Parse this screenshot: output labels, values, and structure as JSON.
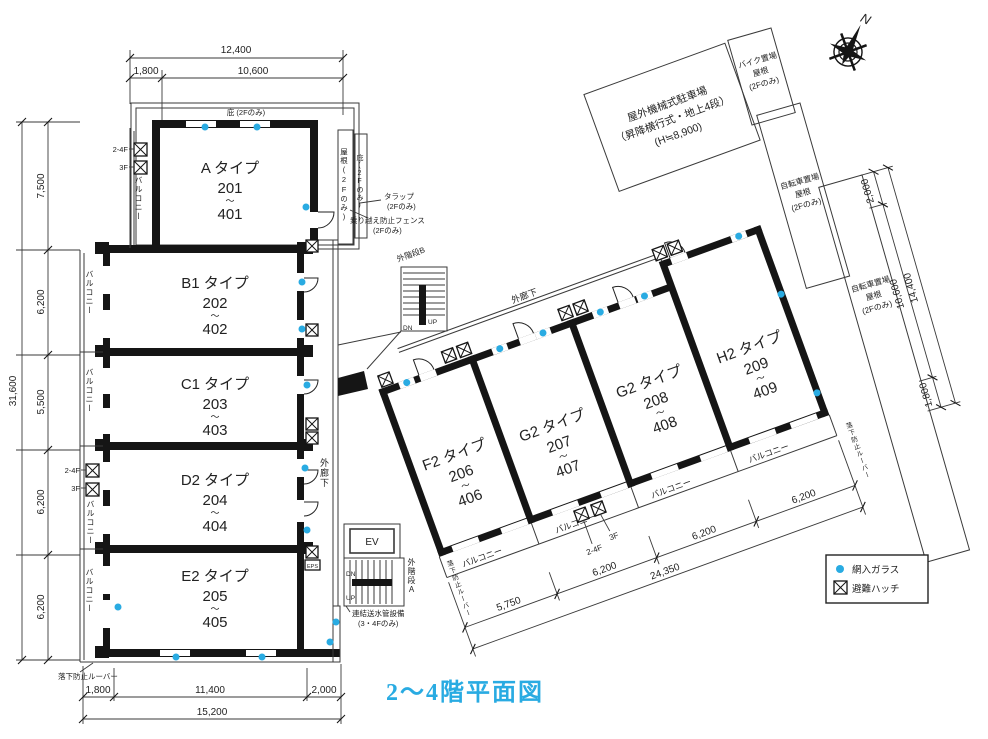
{
  "title": "2〜4階平面図",
  "colors": {
    "accent": "#29ABE2",
    "line": "#1a1a1a"
  },
  "compass_label": "N",
  "legend": {
    "wired_glass": "網入ガラス",
    "escape_hatch": "避難ハッチ"
  },
  "rooms": [
    {
      "type": "A タイプ",
      "top": "201",
      "tilde": "〜",
      "bottom": "401"
    },
    {
      "type": "B1 タイプ",
      "top": "202",
      "tilde": "〜",
      "bottom": "402"
    },
    {
      "type": "C1 タイプ",
      "top": "203",
      "tilde": "〜",
      "bottom": "403"
    },
    {
      "type": "D2 タイプ",
      "top": "204",
      "tilde": "〜",
      "bottom": "404"
    },
    {
      "type": "E2 タイプ",
      "top": "205",
      "tilde": "〜",
      "bottom": "405"
    },
    {
      "type": "F2 タイプ",
      "top": "206",
      "tilde": "〜",
      "bottom": "406"
    },
    {
      "type": "G2 タイプ",
      "top": "207",
      "tilde": "〜",
      "bottom": "407"
    },
    {
      "type": "G2 タイプ",
      "top": "208",
      "tilde": "〜",
      "bottom": "408"
    },
    {
      "type": "H2 タイプ",
      "top": "209",
      "tilde": "〜",
      "bottom": "409"
    }
  ],
  "labels": {
    "balcony": "バルコニー",
    "corridor": "外廊下",
    "stair_a": "外階段A",
    "stair_b": "外階段B",
    "up": "UP",
    "dn": "DN",
    "ev": "EV",
    "eps": "EPS",
    "canopy_top": "庇 (2Fのみ)",
    "roof_side": "屋根(2Fのみ)",
    "canopy_side": "庇(2Fのみ)",
    "ladder_1": "タラップ",
    "ladder_2": "(2Fのみ)",
    "fence_1": "乗り越え防止フェンス",
    "fence_2": "(2Fのみ)",
    "standpipe_1": "連結送水管設備",
    "standpipe_2": "(3・4Fのみ)",
    "louver": "落下防止ルーバー",
    "hatch_24f": "2-4F",
    "hatch_3f": "3F",
    "parking_1": "屋外機械式駐車場",
    "parking_2": "（昇降横行式・地上4段）",
    "parking_3": "(H≒8,900)",
    "bike_1": "バイク置場",
    "bike_2": "屋根",
    "bike_3": "(2Fのみ)",
    "bicycle_1": "自転車置場",
    "bicycle_2": "屋根",
    "bicycle_3": "(2Fのみ)"
  },
  "dims": {
    "top_total": "12,400",
    "top_a": "1,800",
    "top_b": "10,600",
    "left_1": "7,500",
    "left_2": "6,200",
    "left_3": "5,500",
    "left_4": "6,200",
    "left_5": "6,200",
    "left_total": "31,600",
    "bottom_a": "1,800",
    "bottom_b": "11,400",
    "bottom_c": "2,000",
    "bottom_total": "15,200",
    "wing_1": "5,750",
    "wing_2": "6,200",
    "wing_3": "6,200",
    "wing_4": "6,200",
    "wing_total": "24,350",
    "strip_1": "2,000",
    "strip_2": "10,600",
    "strip_3": "1,800",
    "strip_total": "14,400"
  }
}
